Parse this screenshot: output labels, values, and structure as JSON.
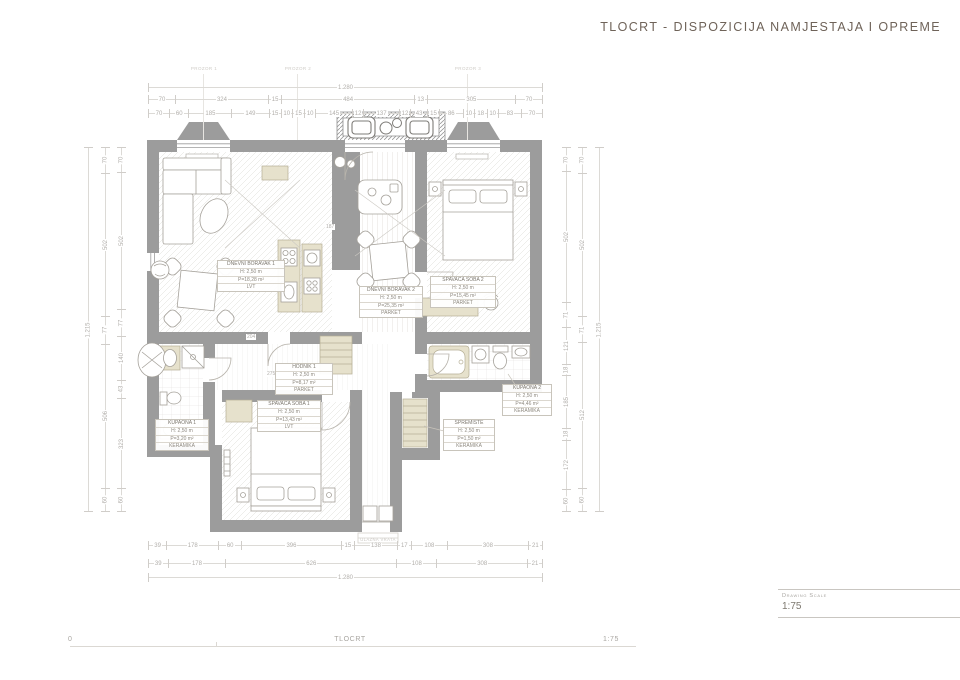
{
  "header": {
    "title": "TLOCRT - DISPOZICIJA NAMJESTAJA I OPREME"
  },
  "scale_box": {
    "label": "Drawing Scale",
    "value": "1:75"
  },
  "footer": {
    "left": "0",
    "center": "TLOCRT",
    "right": "1:75"
  },
  "plan": {
    "window_labels": [
      "PROZOR 1",
      "PROZOR 2",
      "PROZOR 3"
    ],
    "entrance_label": "ULAZNA VRATA",
    "interior_dims": {
      "d1": "204",
      "d2": "275",
      "d3": "187"
    },
    "rooms": [
      {
        "name": "DNEVNI BORAVAK 1",
        "height": "H: 2,50 m",
        "area": "P=18,28 m²",
        "floor": "LVT"
      },
      {
        "name": "DNEVNI BORAVAK 2",
        "height": "H: 2,50 m",
        "area": "P=25,35 m²",
        "floor": "PARKET"
      },
      {
        "name": "SPAVAĆA SOBA 2",
        "height": "H: 2,50 m",
        "area": "P=15,45 m²",
        "floor": "PARKET"
      },
      {
        "name": "KUPAONA 1",
        "height": "H: 2,50 m",
        "area": "P=3,20 m²",
        "floor": "KERAMIKA"
      },
      {
        "name": "SPAVAĆA SOBA 1",
        "height": "H: 2,50 m",
        "area": "P=13,43 m²",
        "floor": "LVT"
      },
      {
        "name": "HODNIK 1",
        "height": "H: 2,50 m",
        "area": "P=8,17 m²",
        "floor": "PARKET"
      },
      {
        "name": "SPREMIŠTE",
        "height": "H: 2,50 m",
        "area": "P=1,50 m²",
        "floor": "KERAMIKA"
      },
      {
        "name": "KUPAONA 2",
        "height": "H: 2,50 m",
        "area": "P=4,46 m²",
        "floor": "KERAMIKA"
      }
    ]
  },
  "dimensions": {
    "top": {
      "total": [
        "1.280"
      ],
      "row1": [
        "70",
        "324",
        "15",
        "484",
        "13",
        "305",
        "70"
      ],
      "row2": [
        "70",
        "60",
        "185",
        "149",
        "15",
        "10",
        "15",
        "10",
        "145",
        "12",
        "137",
        "12",
        "43",
        "15",
        "86",
        "10",
        "18",
        "10",
        "83",
        "70"
      ]
    },
    "bottom": {
      "row1": [
        "39",
        "178",
        "60",
        "396",
        "15",
        "138",
        "17",
        "108",
        "308",
        "21"
      ],
      "row2": [
        "39",
        "178",
        "626",
        "108",
        "308",
        "21"
      ],
      "total": [
        "1.280"
      ]
    },
    "left": {
      "total": [
        "1.215"
      ],
      "mid": [
        "70",
        "502",
        "77",
        "506",
        "60"
      ],
      "inner": [
        "70",
        "502",
        "77",
        "140",
        "43",
        "323",
        "60"
      ]
    },
    "right": {
      "inner": [
        "70",
        "502",
        "71",
        "121",
        "18",
        "185",
        "18",
        "172",
        "60"
      ],
      "mid": [
        "70",
        "502",
        "71",
        "512",
        "60"
      ],
      "total": [
        "1.215"
      ]
    }
  },
  "colors": {
    "wall": "#9c9c9c",
    "cabinetry": "#e6e1cc",
    "title_text": "#6f6359"
  }
}
